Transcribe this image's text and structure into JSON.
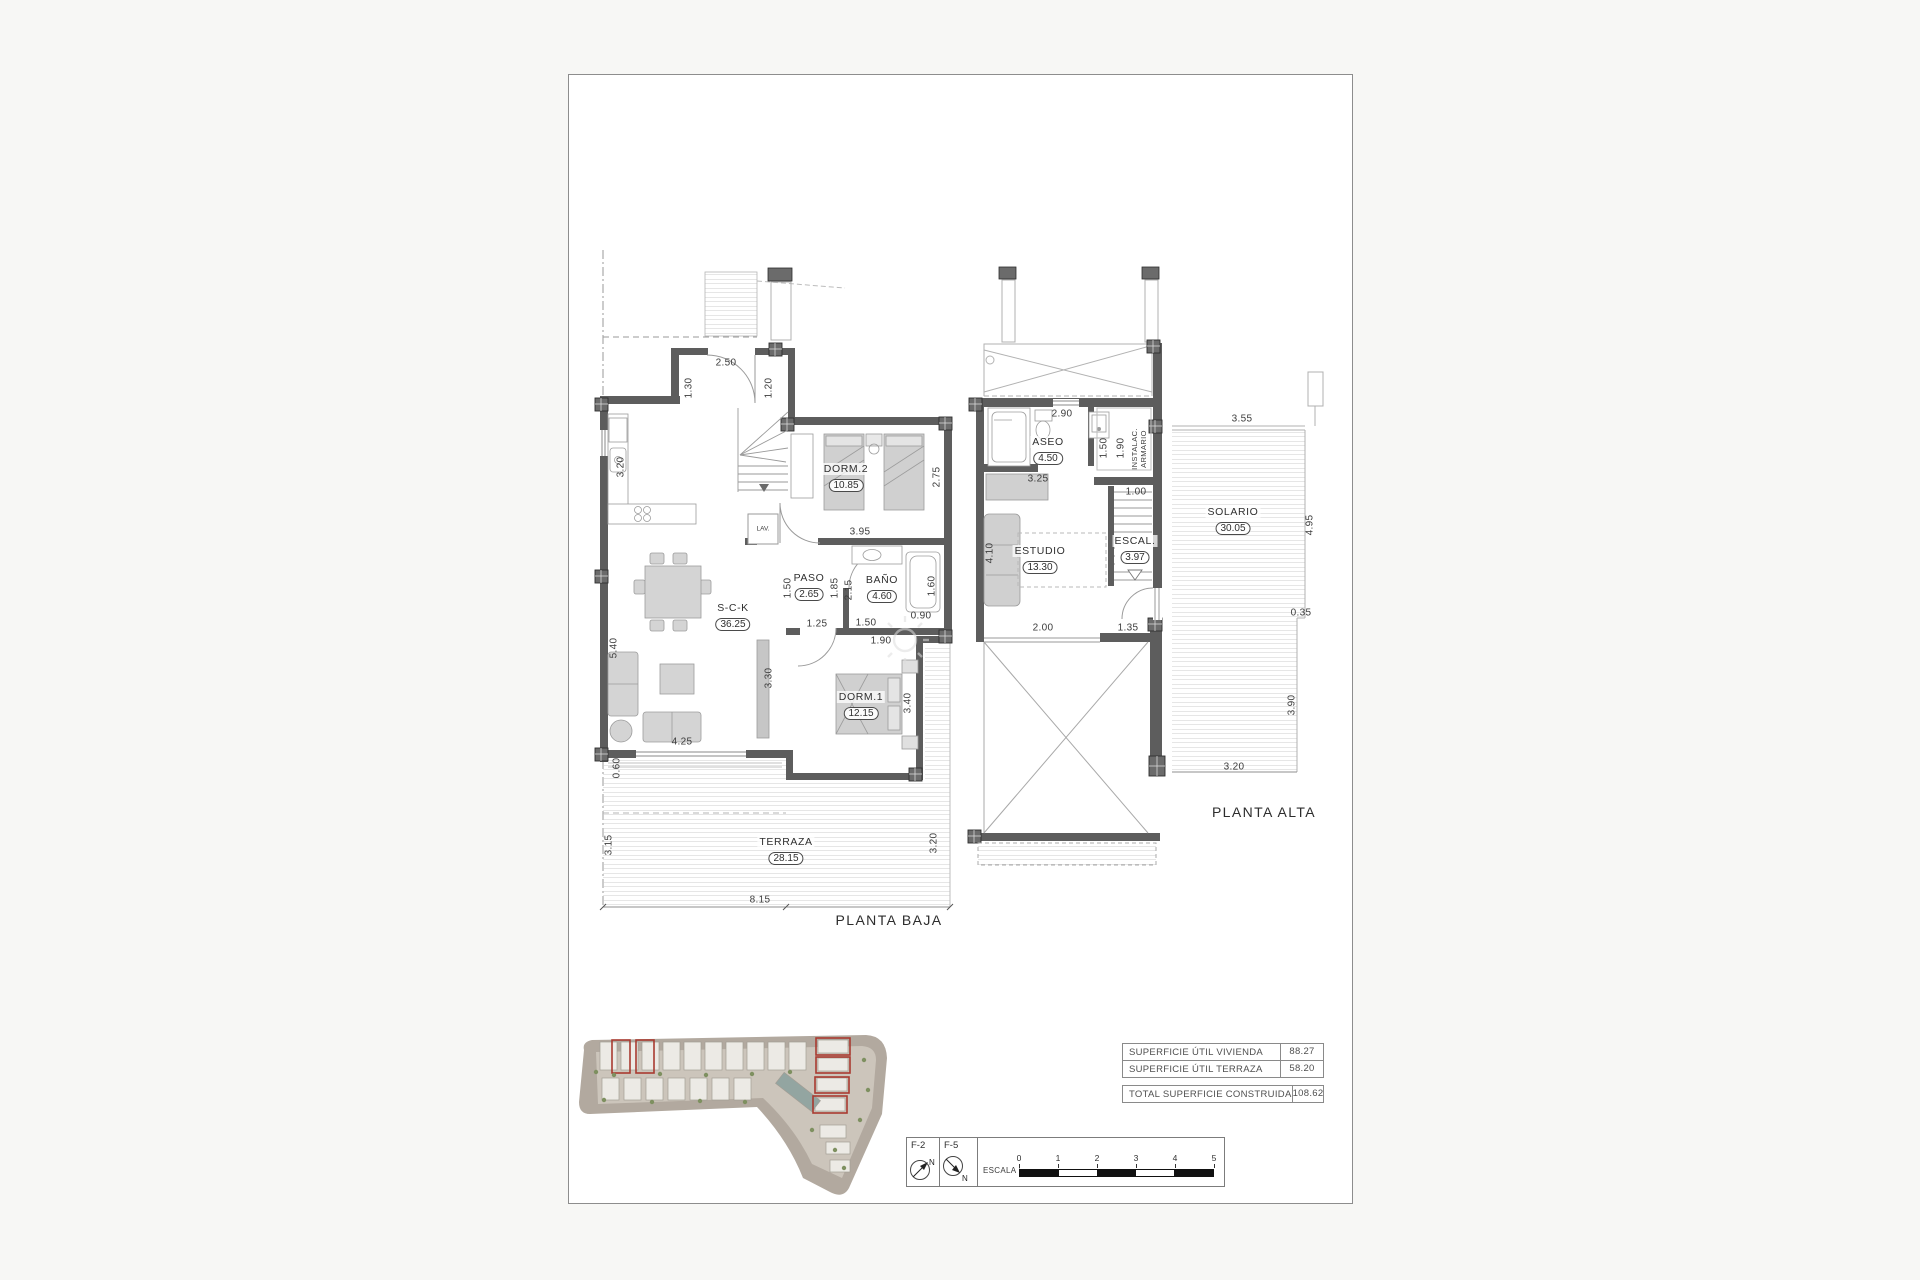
{
  "colors": {
    "wall": "#5d5d5d",
    "hatch": "#c8c8c8",
    "red_highlight": "#a83a30",
    "text": "#3c3c3c"
  },
  "watermark": {
    "icon": "sun-icon"
  },
  "baja": {
    "title": "PLANTA BAJA",
    "rooms": {
      "dorm2": {
        "name": "DORM.2",
        "area": "10.85"
      },
      "paso": {
        "name": "PASO",
        "area": "2.65"
      },
      "bano": {
        "name": "BAÑO",
        "area": "4.60"
      },
      "sck": {
        "name": "S-C-K",
        "area": "36.25"
      },
      "dorm1": {
        "name": "DORM.1",
        "area": "12.15"
      },
      "terraza": {
        "name": "TERRAZA",
        "area": "28.15"
      }
    },
    "lav": "LAV.",
    "dims": {
      "door": "2.50",
      "d130": "1.30",
      "d120": "1.20",
      "k320": "3.20",
      "d275": "2.75",
      "d395": "3.95",
      "d150v": "1.50",
      "d185": "1.85",
      "d215": "2.15",
      "d160": "1.60",
      "d090": "0.90",
      "d125": "1.25",
      "d150h": "1.50",
      "d190": "1.90",
      "d540": "5.40",
      "d330": "3.30",
      "d340": "3.40",
      "d425": "4.25",
      "d060": "0.60",
      "t315": "3.15",
      "t320": "3.20",
      "t815": "8.15"
    }
  },
  "alta": {
    "title": "PLANTA ALTA",
    "rooms": {
      "aseo": {
        "name": "ASEO",
        "area": "4.50"
      },
      "estudio": {
        "name": "ESTUDIO",
        "area": "13.30"
      },
      "escal": {
        "name": "ESCAL.",
        "area": "3.97"
      },
      "solario": {
        "name": "SOLARIO",
        "area": "30.05"
      }
    },
    "instalac": {
      "line1": "INSTALAC.",
      "line2": "ARMARIO"
    },
    "dims": {
      "d290": "2.90",
      "d150": "1.50",
      "d190": "1.90",
      "d100": "1.00",
      "d325": "3.25",
      "d410": "4.10",
      "d200": "2.00",
      "d135": "1.35",
      "d355": "3.55",
      "d495": "4.95",
      "d035": "0.35",
      "d390": "3.90",
      "d320": "3.20"
    }
  },
  "summary": {
    "rows": [
      {
        "label": "SUPERFICIE ÚTIL VIVIENDA",
        "value": "88.27"
      },
      {
        "label": "SUPERFICIE ÚTIL TERRAZA",
        "value": "58.20"
      }
    ],
    "total": {
      "label": "TOTAL SUPERFICIE CONSTRUIDA",
      "value": "108.62"
    }
  },
  "titleblock": {
    "f2": "F-2",
    "f5": "F-5",
    "north": "N",
    "scale_label": "ESCALA :",
    "ticks": [
      "0",
      "1",
      "2",
      "3",
      "4",
      "5"
    ]
  }
}
